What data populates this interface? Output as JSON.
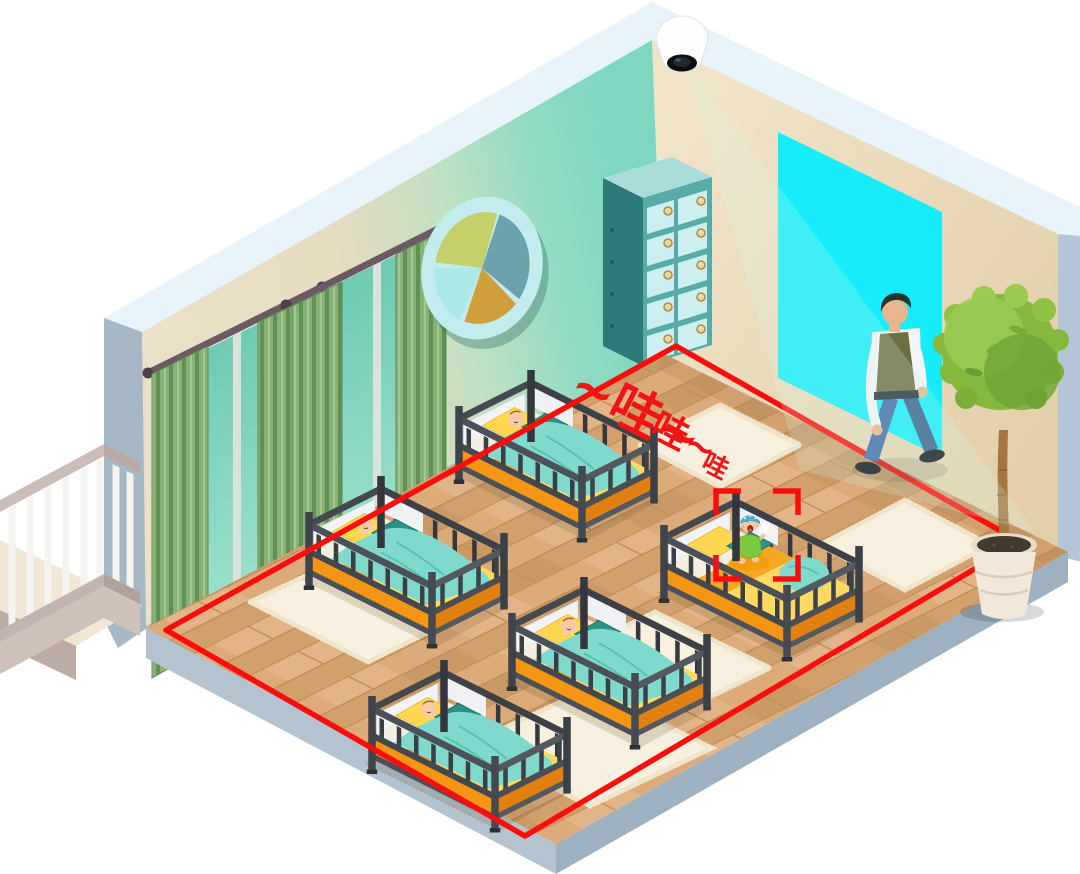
{
  "annotations": {
    "cry_text_large": "~哇~",
    "cry_text_medium": "哇~",
    "cry_text_small": "哇"
  },
  "palette": {
    "alert_red": "#f21414",
    "detection_zone_red": "#fb0d0d",
    "doorway_cyan": "#16ecfa",
    "wall_beige": "#e9dcc2",
    "camera_cone_teal": "#7fd7c2",
    "floor_wood_tan": "#d7a572",
    "platform_blue_gray": "#a2b6c4",
    "crib_frame_gray": "#44484f",
    "mattress_orange": "#f59514",
    "bedding_yellow": "#ffda60",
    "blanket_teal": "#7fd9cc",
    "pillow_accent_teal": "#2b9287",
    "curtain_green": "#86b176",
    "cabinet_teal": "#58aca8",
    "plant_green": "#86b83e",
    "baby_onesie_green": "#7cc83e",
    "baby_hat_blue": "#49aecb"
  }
}
